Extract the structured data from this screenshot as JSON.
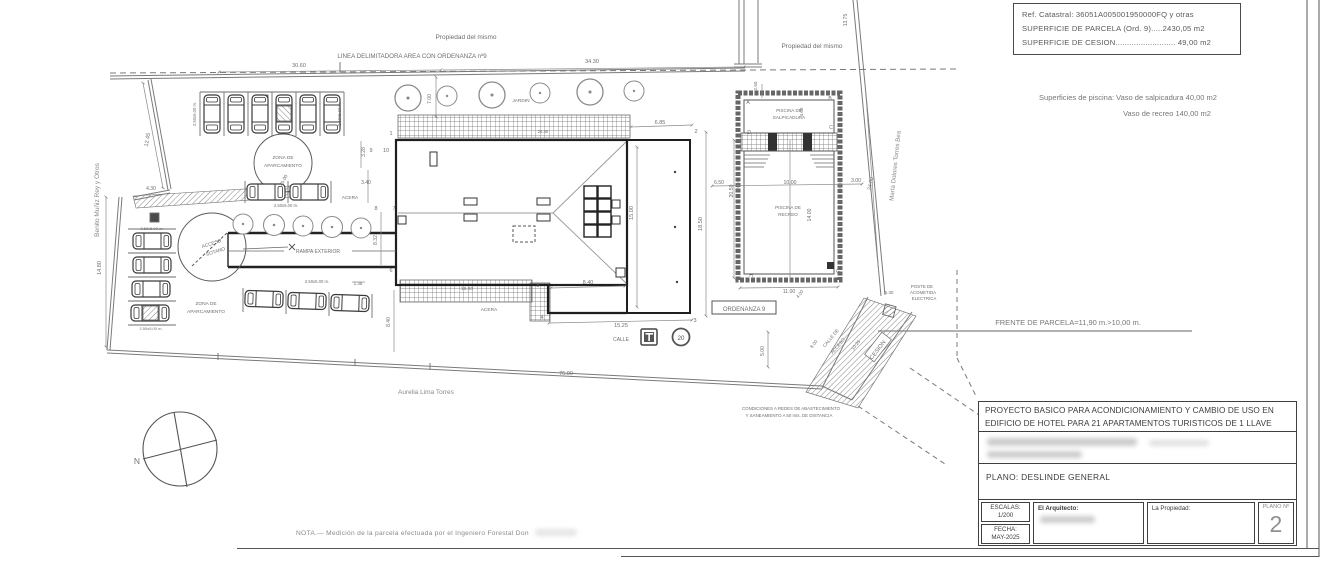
{
  "colors": {
    "line_gray": "#6e6e6e",
    "wall_dark": "#1f1f1f",
    "text_gray": "#777777",
    "street_gray": "#8a8a8a"
  },
  "sheet": {
    "info_box": {
      "line1": "Ref. Catastral: 36051A005001950000FQ y otras",
      "line2": "SUPERFICIE DE PARCELA (Ord. 9).....2430,05 m2",
      "line3": "SUPERFICIE DE CESION.......................... 49,00 m2"
    },
    "title_block": {
      "line1": "PROYECTO BASICO PARA ACONDICIONAMIENTO Y CAMBIO DE USO EN",
      "line2": "EDIFICIO DE HOTEL PARA 21 APARTAMENTOS TURISTICOS DE 1 LLAVE",
      "plano": "PLANO: DESLINDE GENERAL",
      "escalas_label": "ESCALAS:",
      "escalas_value": "1/200",
      "fecha_label": "FECHA:",
      "fecha_value": "MAY-2025",
      "arquitecto_label": "El Arquitecto:",
      "propiedad_label": "La Propiedad:",
      "plano_no_label": "PLANO Nº",
      "plano_no_value": "2"
    },
    "nota": "NOTA.— Medición de la parcela efectuada por el Ingeniero Forestal Don"
  },
  "plan": {
    "texts": [
      {
        "n": "label-propiedad-del-mismo-1",
        "t": "Propiedad del mismo",
        "x": 466,
        "y": 39,
        "s": 6.5
      },
      {
        "n": "label-linea-delimitadora",
        "t": "LINEA DELIMITADORA AREA CON ORDENANZA nº9",
        "x": 412,
        "y": 58,
        "s": 6.2
      },
      {
        "n": "label-propiedad-del-mismo-2",
        "t": "Propiedad del mismo",
        "x": 812,
        "y": 48,
        "s": 6.5
      },
      {
        "n": "dim-30-60",
        "t": "30.60",
        "x": 299,
        "y": 67
      },
      {
        "n": "dim-34-30",
        "t": "34.30",
        "x": 592,
        "y": 63
      },
      {
        "n": "dim-13-75",
        "t": "13.75",
        "x": 847,
        "y": 20,
        "r": -90,
        "s": 5
      },
      {
        "n": "dim-12-45",
        "t": "12.45",
        "x": 149,
        "y": 140,
        "r": -80
      },
      {
        "n": "dim-4-30",
        "t": "4.30",
        "x": 151,
        "y": 190,
        "s": 5
      },
      {
        "n": "street-benito-muniz",
        "t": "Benito Muñiz Rey y Otros",
        "x": 99,
        "y": 200,
        "r": -90,
        "s": 6.5,
        "c": "#8a8a8a"
      },
      {
        "n": "dim-14-80",
        "t": "14.80",
        "x": 101,
        "y": 268,
        "r": -90
      },
      {
        "n": "dim-76-00",
        "t": "76.00",
        "x": 566,
        "y": 375
      },
      {
        "n": "street-aurelia-lima",
        "t": "Aurelia Lima Torres",
        "x": 426,
        "y": 394,
        "s": 6.5,
        "c": "#8a8a8a"
      },
      {
        "n": "label-jardin",
        "t": "JARDIN",
        "x": 521,
        "y": 102,
        "s": 4.8
      },
      {
        "n": "dim-7-00",
        "t": "7.00",
        "x": 431,
        "y": 99,
        "r": -90,
        "s": 5
      },
      {
        "n": "stall-size",
        "t": "2.50x5.00 m.",
        "x": 196,
        "y": 114,
        "r": -90,
        "s": 4.2
      },
      {
        "n": "stall-size",
        "t": "2.50x5.00 m.",
        "x": 341,
        "y": 114,
        "r": -90,
        "s": 4.2
      },
      {
        "n": "label-zona-aparcamiento-1a",
        "t": "ZONA DE",
        "x": 283,
        "y": 159,
        "s": 4.8
      },
      {
        "n": "label-zona-aparcamiento-1b",
        "t": "APARCAMIENTO",
        "x": 283,
        "y": 167,
        "s": 4.8
      },
      {
        "n": "dim-45-00",
        "t": "45.00",
        "x": 285,
        "y": 181,
        "r": -62,
        "s": 4.8
      },
      {
        "n": "label-acceso-sotano-a",
        "t": "ACCESO",
        "x": 212,
        "y": 245,
        "r": -18,
        "s": 4.8
      },
      {
        "n": "label-acceso-sotano-b",
        "t": "SOTANO",
        "x": 216,
        "y": 253,
        "r": -18,
        "s": 4.8
      },
      {
        "n": "label-rampa-exterior",
        "t": "RAMPA EXTERIOR",
        "x": 318,
        "y": 253,
        "s": 5
      },
      {
        "n": "label-acera-1",
        "t": "ACERA",
        "x": 350,
        "y": 199,
        "s": 4.8
      },
      {
        "n": "label-acera-2",
        "t": "ACERA",
        "x": 489,
        "y": 311,
        "s": 4.8
      },
      {
        "n": "label-zona-aparcamiento-2a",
        "t": "ZONA DE",
        "x": 206,
        "y": 305,
        "s": 4.8
      },
      {
        "n": "label-zona-aparcamiento-2b",
        "t": "APARCAMIENTO",
        "x": 206,
        "y": 313,
        "s": 4.8
      },
      {
        "n": "stall-size",
        "t": "2.50x5.00 m.",
        "x": 286,
        "y": 207,
        "s": 4.2
      },
      {
        "n": "stall-size",
        "t": "2.50x5.00 m.",
        "x": 317,
        "y": 283,
        "s": 4.2
      },
      {
        "n": "stall-size",
        "t": "2.50x5.00 m.",
        "x": 152,
        "y": 230,
        "s": 4
      },
      {
        "n": "stall-size",
        "t": "2.50x5.00 m.",
        "x": 151,
        "y": 330,
        "s": 4
      },
      {
        "n": "dim-3-28",
        "t": "3.28",
        "x": 365,
        "y": 152,
        "r": -90,
        "s": 5
      },
      {
        "n": "dim-3-40",
        "t": "3.40",
        "x": 366,
        "y": 184,
        "s": 5
      },
      {
        "n": "dim-8-32",
        "t": "8.32",
        "x": 377,
        "y": 240,
        "r": -90,
        "s": 5
      },
      {
        "n": "dim-1-38",
        "t": "1.38",
        "x": 358,
        "y": 285,
        "s": 4.5
      },
      {
        "n": "dim-8-40-v",
        "t": "8.40",
        "x": 390,
        "y": 322,
        "r": -90,
        "s": 5
      },
      {
        "n": "dim-16-00",
        "t": "16.00",
        "x": 467,
        "y": 290,
        "s": 4.8
      },
      {
        "n": "dim-24-40",
        "t": "24.40",
        "x": 543,
        "y": 133,
        "s": 4.2
      },
      {
        "n": "dim-6-85",
        "t": "6.85",
        "x": 660,
        "y": 124,
        "s": 5.5
      },
      {
        "n": "dim-15-00",
        "t": "15.00",
        "x": 633,
        "y": 213,
        "r": -90,
        "s": 5.5
      },
      {
        "n": "dim-18-50",
        "t": "18.50",
        "x": 702,
        "y": 224,
        "r": -90,
        "s": 5.5
      },
      {
        "n": "dim-8-40-h",
        "t": "8.40",
        "x": 588,
        "y": 284,
        "s": 5.5
      },
      {
        "n": "dim-15-25",
        "t": "15.25",
        "x": 621,
        "y": 327,
        "s": 5.5
      },
      {
        "n": "dim-5-00",
        "t": "5.00",
        "x": 764,
        "y": 351,
        "r": -90,
        "s": 5
      },
      {
        "n": "vertex-1",
        "t": "1",
        "x": 391,
        "y": 135,
        "s": 5.5
      },
      {
        "n": "vertex-9",
        "t": "9",
        "x": 371,
        "y": 152,
        "s": 5.5
      },
      {
        "n": "vertex-10",
        "t": "10",
        "x": 386,
        "y": 152,
        "s": 5.5
      },
      {
        "n": "vertex-8",
        "t": "8",
        "x": 376,
        "y": 210,
        "s": 5.5
      },
      {
        "n": "vertex-7",
        "t": "7",
        "x": 394,
        "y": 210,
        "s": 5.5
      },
      {
        "n": "vertex-6",
        "t": "6",
        "x": 391,
        "y": 272,
        "s": 5.5
      },
      {
        "n": "vertex-5",
        "t": "5",
        "x": 538,
        "y": 287,
        "s": 5.5
      },
      {
        "n": "vertex-4",
        "t": "4",
        "x": 542,
        "y": 319,
        "s": 5.5
      },
      {
        "n": "vertex-3",
        "t": "3",
        "x": 695,
        "y": 322,
        "s": 5.5
      },
      {
        "n": "vertex-2",
        "t": "2",
        "x": 696,
        "y": 133,
        "s": 5.5
      },
      {
        "n": "label-piscina-salpicadura-a",
        "t": "PISCINA DE",
        "x": 789,
        "y": 112,
        "s": 4.6
      },
      {
        "n": "label-piscina-salpicadura-b",
        "t": "SALPICADURA",
        "x": 789,
        "y": 119,
        "s": 4.6
      },
      {
        "n": "label-piscina-recreo-a",
        "t": "PISCINA DE",
        "x": 788,
        "y": 209,
        "s": 4.6
      },
      {
        "n": "label-piscina-recreo-b",
        "t": "RECREO",
        "x": 788,
        "y": 216,
        "s": 4.6
      },
      {
        "n": "dim-2-50",
        "t": "2.50",
        "x": 757,
        "y": 86,
        "r": -90,
        "s": 4.6
      },
      {
        "n": "dim-4-00-pool",
        "t": "4.00",
        "x": 803,
        "y": 112,
        "r": -90,
        "s": 4.6
      },
      {
        "n": "dim-6-50",
        "t": "6.50",
        "x": 719,
        "y": 184,
        "s": 5.2
      },
      {
        "n": "dim-20-50",
        "t": "20.50",
        "x": 733,
        "y": 191,
        "r": -90,
        "s": 5.2
      },
      {
        "n": "dim-10-00",
        "t": "10.00",
        "x": 790,
        "y": 184,
        "s": 5.2
      },
      {
        "n": "dim-3-00",
        "t": "3.00",
        "x": 856,
        "y": 182,
        "s": 5.2
      },
      {
        "n": "dim-14-00",
        "t": "14.00",
        "x": 811,
        "y": 215,
        "r": -90,
        "s": 5.2
      },
      {
        "n": "dim-11-00",
        "t": "11.00",
        "x": 789,
        "y": 293,
        "s": 5.2
      },
      {
        "n": "dim-24-00",
        "t": "24.00",
        "x": 872,
        "y": 184,
        "r": -78,
        "s": 5.2
      },
      {
        "n": "street-maria-dolores",
        "t": "María Dolores Torres Bea",
        "x": 897,
        "y": 166,
        "r": -84,
        "s": 6.2,
        "c": "#8a8a8a"
      },
      {
        "n": "pool-corner-a",
        "t": "A",
        "x": 748,
        "y": 104,
        "s": 5
      },
      {
        "n": "pool-corner-b",
        "t": "B",
        "x": 830,
        "y": 100,
        "s": 5
      },
      {
        "n": "pool-corner-d",
        "t": "D",
        "x": 749,
        "y": 134,
        "s": 5
      },
      {
        "n": "pool-corner-c",
        "t": "C",
        "x": 831,
        "y": 129,
        "s": 5
      },
      {
        "n": "pool-corner-h",
        "t": "H",
        "x": 751,
        "y": 277,
        "s": 5
      },
      {
        "n": "pool-corner-g",
        "t": "G",
        "x": 838,
        "y": 273,
        "s": 5
      },
      {
        "n": "label-ordenanza-9",
        "t": "ORDENANZA 9",
        "x": 744,
        "y": 311,
        "s": 6
      },
      {
        "n": "label-calle",
        "t": "CALLE",
        "x": 621,
        "y": 341,
        "s": 5
      },
      {
        "n": "sign-speed-value",
        "t": "20",
        "x": 681,
        "y": 340,
        "s": 6,
        "c": "#555555"
      },
      {
        "n": "label-poste-a",
        "t": "POSTE DE",
        "x": 922,
        "y": 288,
        "s": 4.4
      },
      {
        "n": "label-poste-b",
        "t": "ACOMETIDA",
        "x": 923,
        "y": 294,
        "s": 4.4
      },
      {
        "n": "label-poste-c",
        "t": "ELECTRICA",
        "x": 924,
        "y": 300,
        "s": 4.4
      },
      {
        "n": "label-frente-parcela",
        "t": "FRENTE DE PARCELA=11,90 m.>10,00 m.",
        "x": 1068,
        "y": 325,
        "s": 7.5,
        "c": "#777777"
      },
      {
        "n": "label-calle-acceso-a",
        "t": "CALLE DE",
        "x": 832,
        "y": 339,
        "r": -50,
        "s": 4.6
      },
      {
        "n": "label-calle-acceso-b",
        "t": "ACCESO",
        "x": 839,
        "y": 347,
        "r": -50,
        "s": 4.6
      },
      {
        "n": "label-cesion",
        "t": "CESION",
        "x": 879,
        "y": 351,
        "r": -52,
        "s": 5.8
      },
      {
        "n": "dim-10-25",
        "t": "10.25",
        "x": 857,
        "y": 346,
        "r": -52,
        "s": 4.6
      },
      {
        "n": "dim-8-00",
        "t": "8.00",
        "x": 815,
        "y": 345,
        "r": -52,
        "s": 4.6
      },
      {
        "n": "dim-4-00-se",
        "t": "4.00",
        "x": 801,
        "y": 295,
        "r": -52,
        "s": 4.6
      },
      {
        "n": "dim-5-30",
        "t": "5.30",
        "x": 889,
        "y": 294,
        "s": 4.6
      },
      {
        "n": "label-condiciones-a",
        "t": "CONDICIONES A REDES DE ABASTECIMIENTO",
        "x": 791,
        "y": 410,
        "s": 4.4
      },
      {
        "n": "label-condiciones-b",
        "t": "Y SANEAMIENTO A 50 mts. DE DISTANCIA",
        "x": 789,
        "y": 417,
        "s": 4.4
      },
      {
        "n": "compass-north-label",
        "t": "N",
        "x": 137,
        "y": 464,
        "s": 8.5,
        "c": "#777777"
      },
      {
        "n": "note-superficies-1",
        "t": "Superficies de piscina: Vaso de salpicadura 40,00 m2",
        "x": 1128,
        "y": 100,
        "s": 7.5,
        "c": "#777777"
      },
      {
        "n": "note-superficies-2",
        "t": "Vaso de recreo 140,00 m2",
        "x": 1167,
        "y": 116,
        "s": 7.5,
        "c": "#777777"
      }
    ],
    "cars": [
      {
        "x": 212,
        "y": 114,
        "r": -90
      },
      {
        "x": 236,
        "y": 114,
        "r": -90
      },
      {
        "x": 260,
        "y": 114,
        "r": -90
      },
      {
        "x": 284,
        "y": 114,
        "r": -90,
        "h": 1
      },
      {
        "x": 308,
        "y": 114,
        "r": -90
      },
      {
        "x": 332,
        "y": 114,
        "r": -90
      },
      {
        "x": 266,
        "y": 192,
        "r": 0
      },
      {
        "x": 309,
        "y": 192,
        "r": 0
      },
      {
        "x": 264,
        "y": 299,
        "r": 2
      },
      {
        "x": 307,
        "y": 301,
        "r": 2
      },
      {
        "x": 350,
        "y": 303,
        "r": 2
      },
      {
        "x": 152,
        "y": 241,
        "r": 0
      },
      {
        "x": 152,
        "y": 265,
        "r": 0
      },
      {
        "x": 151,
        "y": 289,
        "r": 0
      },
      {
        "x": 150,
        "y": 313,
        "r": 0,
        "h": 1
      }
    ],
    "trees": [
      {
        "x": 408,
        "y": 98,
        "s": 1.3
      },
      {
        "x": 447,
        "y": 96,
        "s": 1
      },
      {
        "x": 492,
        "y": 95,
        "s": 1.3
      },
      {
        "x": 540,
        "y": 93,
        "s": 1
      },
      {
        "x": 590,
        "y": 92,
        "s": 1.3
      },
      {
        "x": 634,
        "y": 91,
        "s": 1
      },
      {
        "x": 243,
        "y": 224,
        "s": 1
      },
      {
        "x": 274,
        "y": 225,
        "s": 1.05
      },
      {
        "x": 303,
        "y": 226,
        "s": 1
      },
      {
        "x": 332,
        "y": 227,
        "s": 1.05
      },
      {
        "x": 361,
        "y": 228,
        "s": 1
      }
    ]
  }
}
